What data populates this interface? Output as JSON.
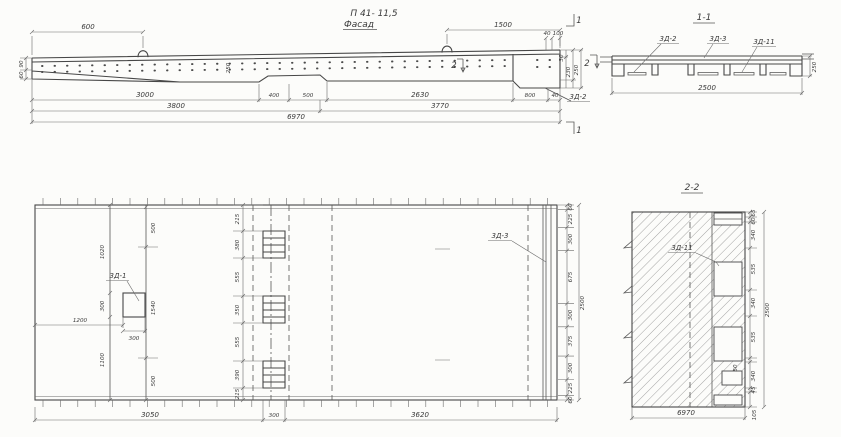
{
  "title": "П 41- 11,5",
  "facade": {
    "label": "Фасад",
    "dim_600": "600",
    "dim_1500": "1500",
    "dim_90": "90",
    "dim_60": "60",
    "dim_250_mid": "250",
    "dim_40": "40",
    "dim_100": "100",
    "dim_30": "30",
    "dim_230": "230",
    "dim_250": "250",
    "row1": [
      "3000",
      "400",
      "500",
      "2630",
      "800",
      "40"
    ],
    "row2": [
      "3800",
      "3770"
    ],
    "total": "6970",
    "mark_1": "1",
    "mark_2": "2",
    "label_3d2": "3Д-2"
  },
  "section_1_1": {
    "title": "1-1",
    "label_3d2": "3Д-2",
    "label_3d3": "3Д-3",
    "label_3d11": "3Д-11",
    "dim_width": "2500",
    "dim_height": "250"
  },
  "plan": {
    "label_3d1": "3Д-1",
    "label_3d3": "3Д-3",
    "dim_1020": "1020",
    "dim_300_sq": "300",
    "dim_1100": "1100",
    "dim_1200": "1200",
    "dim_300_w": "300",
    "dim_500_top": "500",
    "dim_1540": "1540",
    "dim_500_bot": "500",
    "strip": [
      "215",
      "380",
      "555",
      "350",
      "555",
      "390",
      "215"
    ],
    "strip_width": "300",
    "bottom": [
      "3050",
      "300",
      "3620"
    ],
    "right": [
      "60",
      "225",
      "300",
      "675",
      "300",
      "375",
      "300",
      "225",
      "60"
    ],
    "right_total": "2500"
  },
  "section_2_2": {
    "title": "2-2",
    "label_3d11": "3Д-11",
    "right": [
      "65",
      "60",
      "340",
      "535",
      "340",
      "535",
      "50",
      "340",
      "45"
    ],
    "right_total": "2500",
    "bottom": "6970",
    "dim_105": "105"
  }
}
